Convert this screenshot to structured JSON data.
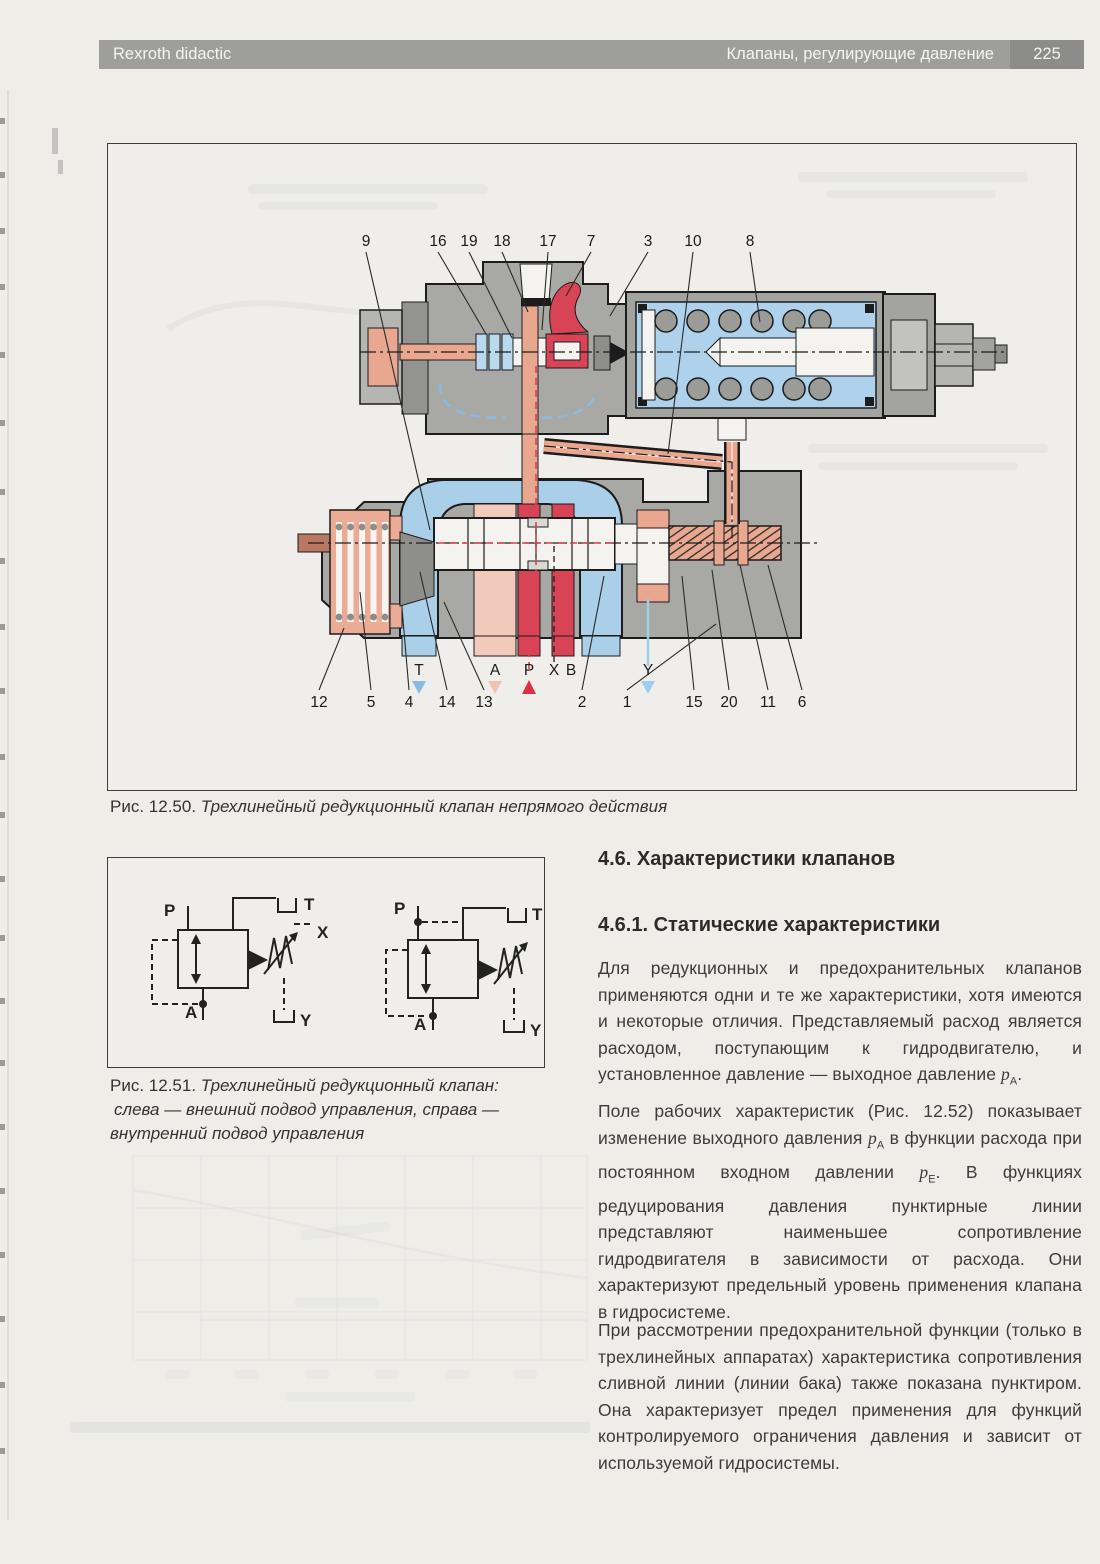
{
  "header": {
    "left": "Rexroth didactic",
    "right": "Клапаны, регулирующие давление",
    "page_number": "225"
  },
  "colors": {
    "header_gray": "#9e9e9c",
    "diagram_body_gray": "#a8a8a4",
    "channel_blue": "#a9cfe9",
    "channel_red": "#d84355",
    "channel_salmon": "#e9a78f",
    "channel_pale_pink": "#f2cabb"
  },
  "figure_12_50": {
    "caption_prefix": "Рис. 12.50.",
    "caption": "Трехлинейный редукционный клапан непрямого действия",
    "top_labels": [
      "9",
      "16",
      "19",
      "18",
      "17",
      "7",
      "3",
      "10",
      "8"
    ],
    "bottom_labels": [
      "12",
      "5",
      "4",
      "14",
      "13",
      "2",
      "1",
      "15",
      "20",
      "11",
      "6"
    ],
    "ports_row": [
      "T",
      "A",
      "P",
      "X",
      "B"
    ],
    "port_y": "Y"
  },
  "figure_12_51": {
    "caption_prefix": "Рис. 12.51.",
    "caption": "Трехлинейный редукционный клапан:",
    "caption_line2": "слева — внешний подвод управления, справа —",
    "caption_line3": "внутренний подвод управления",
    "left_symbol": {
      "p": "P",
      "t": "T",
      "x": "X",
      "a": "A",
      "y": "Y"
    },
    "right_symbol": {
      "p": "P",
      "t": "T",
      "a": "A",
      "y": "Y"
    }
  },
  "main_text": {
    "heading_46": "4.6. Характеристики клапанов",
    "heading_461": "4.6.1. Статические характеристики",
    "paragraphs": [
      [
        {
          "t": "Для редукционных и предохранительных клапанов применяются одни и те же характеристики, хотя имеются и некоторые отличия. Представляемый расход является расходом, поступающим к гидродвигателю, и установленное давление — выходное давление "
        },
        {
          "v": "p",
          "s": "A"
        },
        {
          "t": "."
        }
      ],
      [
        {
          "t": "Поле рабочих характеристик (Рис. 12.52) показывает изменение выходного давления "
        },
        {
          "v": "p",
          "s": "A"
        },
        {
          "t": " в функции расхода при постоянном входном давлении "
        },
        {
          "v": "p",
          "s": "E"
        },
        {
          "t": ". В функциях редуцирования давления пунктирные линии представляют наименьшее сопротивление гидродвигателя в зависимости от расхода. Они характеризуют предельный уровень применения клапана в гидросистеме."
        }
      ],
      [
        {
          "t": "При рассмотрении предохранительной функции (только в трехлинейных аппаратах) характеристика сопротивления сливной линии (линии бака) также показана пунктиром. Она характеризует предел применения для функций контролируемого ограничения давления и зависит от используемой гидросистемы."
        }
      ]
    ]
  }
}
